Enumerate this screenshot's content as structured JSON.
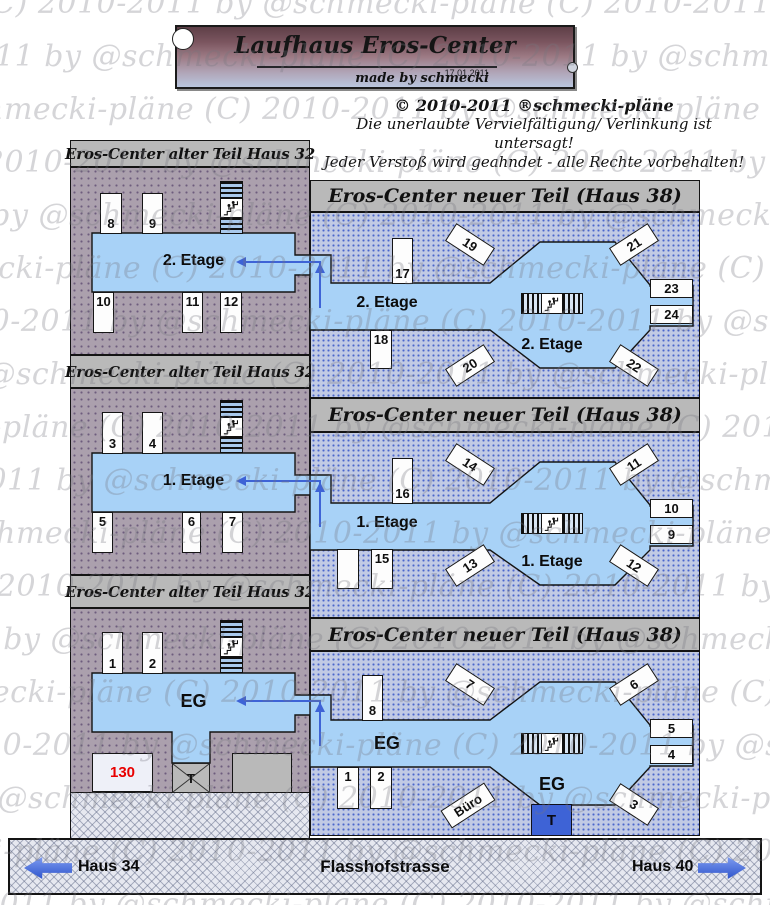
{
  "banner": {
    "title": "Laufhaus Eros-Center",
    "date": "17.01.2011",
    "credit": "made by schmecki"
  },
  "copyright": {
    "line1": "© 2010-2011 ®schmecki-pläne",
    "line2": "Die unerlaubte Vervielfältigung/ Verlinkung ist untersagt!",
    "line3": "Jeder Verstoß wird geahndet - alle Rechte vorbehalten!"
  },
  "watermark": {
    "text": "(C) 2010-2011 by @schmecki-pläne"
  },
  "headers": {
    "old_wing": "Eros-Center  alter Teil Haus 32",
    "new_wing": "Eros-Center  neuer Teil (Haus 38)"
  },
  "street": {
    "left_label": "Haus 34",
    "name": "Flasshofstrasse",
    "right_label": "Haus 40"
  },
  "icons": {
    "stairs": "figures-climbing-steps",
    "entrance_cross": "x-crossed-square"
  },
  "colors": {
    "corridor": "#a8d2f7",
    "purple_bg": "#aba0ad",
    "blue_bg": "#c1cae4",
    "header_gray": "#b9b9b9",
    "arrow_blue": "#3e63d6",
    "entrance_blue": "#3e63d6",
    "room_red": "#e80000"
  },
  "floors": {
    "left2": {
      "label": "2. Etage",
      "top": [
        "8",
        "9"
      ],
      "bottom": [
        "10",
        "11",
        "12"
      ]
    },
    "left1": {
      "label": "1. Etage",
      "top": [
        "3",
        "4"
      ],
      "bottom": [
        "5",
        "6",
        "7"
      ]
    },
    "leftEg": {
      "label": "EG",
      "top": [
        "1",
        "2"
      ],
      "room130": "130",
      "entrance": "T"
    },
    "right2": {
      "label": "2. Etage",
      "label2": "2. Etage",
      "topLeftVert": "17",
      "diagTL": "19",
      "diagTR": "21",
      "rightTop": "23",
      "rightBottom": "24",
      "bottomVert": "18",
      "diagBL": "20",
      "diagBR": "22"
    },
    "right1": {
      "label": "1. Etage",
      "label2": "1. Etage",
      "topLeftVert": "16",
      "diagTL": "14",
      "diagTR": "11",
      "rightTop": "10",
      "rightBottom": "9",
      "bottomVert": "15",
      "diagBL": "13",
      "diagBR": "12"
    },
    "rightEg": {
      "label": "EG",
      "label2": "EG",
      "topLeftVert": "8",
      "diagTL": "7",
      "diagTR": "6",
      "rightTop": "5",
      "rightBottom": "4",
      "bottomVert1": "1",
      "bottomVert2": "2",
      "office": "Büro",
      "diagBR": "3",
      "entrance": "T"
    }
  }
}
